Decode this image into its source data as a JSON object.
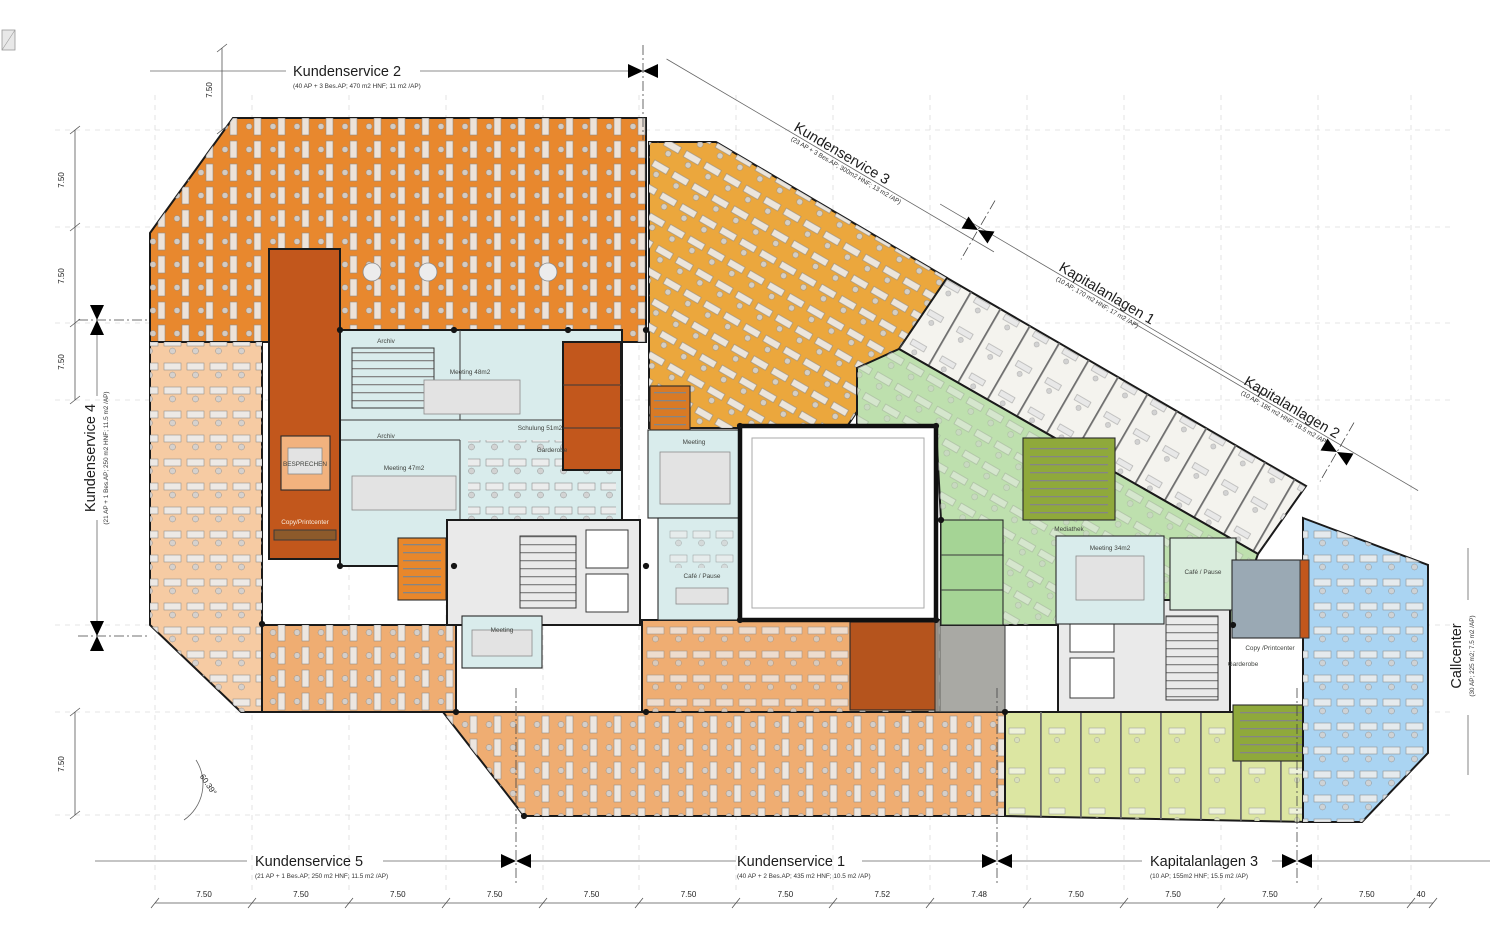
{
  "zones": {
    "ks2": {
      "label": "Kundenservice 2",
      "sublabel": "(40 AP + 3 Bes.AP; 470 m2 HNF; 11 m2 /AP)",
      "color": "#E8882E"
    },
    "ks3": {
      "label": "Kundenservice 3",
      "sublabel": "(23 AP + 3 Bes.AP; 300m2 HNF; 13 m2 /AP)",
      "color": "#EBA73D"
    },
    "kap1": {
      "label": "Kapitalanlagen 1",
      "sublabel": "(10 AP; 170 m2 HNF; 17 m2 /AP)",
      "color": "#F4F3EE"
    },
    "kap2": {
      "label": "Kapitalanlagen 2",
      "sublabel": "(10 AP; 185 m2 HNF; 18.5 m2 /AP)",
      "color": "#F4F3EE"
    },
    "ks4": {
      "label": "Kundenservice 4",
      "sublabel": "(21 AP + 1 Bes.AP; 250 m2 HNF; 11.5 m2 /AP)",
      "color": "#F6CBA3"
    },
    "ks5": {
      "label": "Kundenservice 5",
      "sublabel": "(21 AP + 1 Bes.AP; 250 m2 HNF; 11.5 m2 /AP)",
      "color": "#EFAD72"
    },
    "ks1": {
      "label": "Kundenservice 1",
      "sublabel": "(40 AP + 2 Bes.AP; 435 m2 HNF; 10.5 m2 /AP)",
      "color": "#EFAD72"
    },
    "kap3": {
      "label": "Kapitalanlagen 3",
      "sublabel": "(10 AP; 155m2 HNF; 15.5 m2 /AP)",
      "color": "#DCE6A2"
    },
    "callcenter": {
      "label": "Callcenter",
      "sublabel": "(30 AP; 225 m2; 7.5 m2 /AP)",
      "color": "#AAD4F2"
    }
  },
  "rooms": {
    "archiv_top": "Archiv",
    "archiv_bottom": "Archiv",
    "meeting48": "Meeting 48m2",
    "meeting47": "Meeting 47m2",
    "schulung": "Schulung 51m2",
    "besprechen": "BESPRECHEN",
    "copy_left": "Copy/Printcenter",
    "meeting_left": "Meeting",
    "meeting_center": "Meeting",
    "cafe_center": "Café / Pause",
    "mediathek": "Mediathek",
    "meeting34": "Meeting 34m2",
    "cafe_right": "Café / Pause",
    "copy_right": "Copy /Printcenter",
    "garderobe": "Garderobe"
  },
  "dimensions": {
    "bottom": [
      "7.50",
      "7.50",
      "7.50",
      "7.50",
      "7.50",
      "7.50",
      "7.50",
      "7.52",
      "7.48",
      "7.50",
      "7.50",
      "7.50",
      "7.50"
    ],
    "bottom_end": "40",
    "left": [
      "7.50",
      "7.50",
      "7.50",
      "7.50"
    ],
    "top_left": "7.50",
    "angle": "60.39°"
  },
  "colors": {
    "light_blue_room": "#D9ECEC",
    "dark_orange_room": "#C2571C",
    "olive": "#8FA93B",
    "green_open": "#BEE0AE",
    "green_cells": "#A5D495",
    "gray_core": "#EAEAEA",
    "wall": "#1A1A1A"
  }
}
